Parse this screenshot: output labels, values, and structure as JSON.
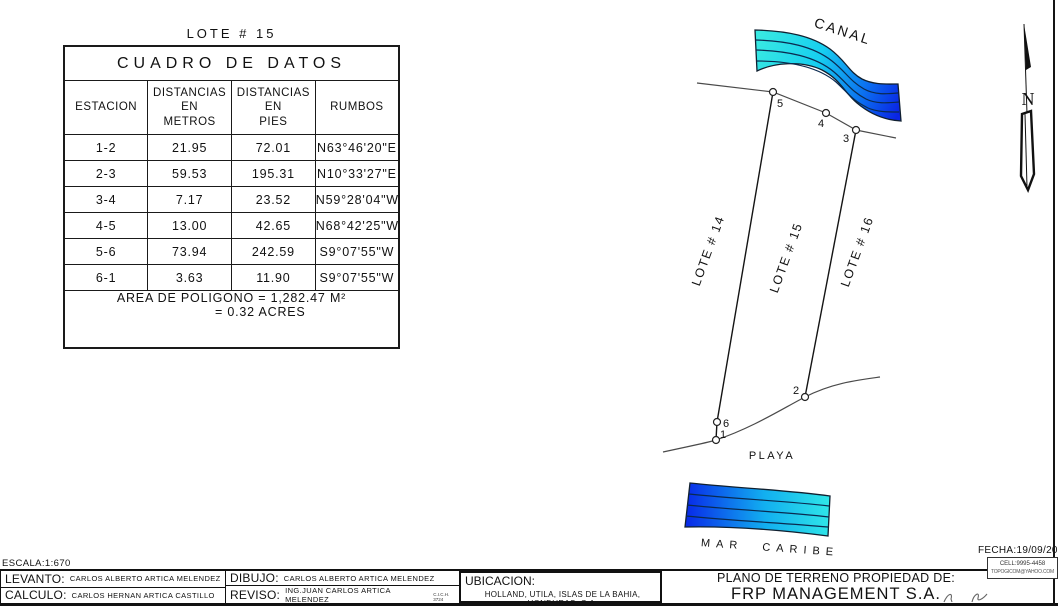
{
  "page": {
    "lot_title": "LOTE # 15",
    "scale": "ESCALA:1:670",
    "date": "FECHA:19/09/2023",
    "cell": "CELL:9995-4458",
    "email": "TOPOGICOM@YAHOO.COM"
  },
  "table": {
    "title": "CUADRO DE DATOS",
    "headers": [
      "ESTACION",
      "DISTANCIAS\nEN\nMETROS",
      "DISTANCIAS\nEN\nPIES",
      "RUMBOS"
    ],
    "rows": [
      [
        "1-2",
        "21.95",
        "72.01",
        "N63°46'20\"E"
      ],
      [
        "2-3",
        "59.53",
        "195.31",
        "N10°33'27\"E"
      ],
      [
        "3-4",
        "7.17",
        "23.52",
        "N59°28'04\"W"
      ],
      [
        "4-5",
        "13.00",
        "42.65",
        "N68°42'25\"W"
      ],
      [
        "5-6",
        "73.94",
        "242.59",
        "S9°07'55\"W"
      ],
      [
        "6-1",
        "3.63",
        "11.90",
        "S9°07'55\"W"
      ]
    ],
    "area_line1": "AREA DE POLIGONO = 1,282.47 M²",
    "area_line2": "= 0.32 ACRES"
  },
  "plan": {
    "canal_label": "CANAL",
    "playa_label": "PLAYA",
    "sea_label": "MAR CARIBE",
    "north_label": "N",
    "lot_labels": [
      "LOTE # 14",
      "LOTE # 15",
      "LOTE # 16"
    ],
    "point_labels": [
      "1",
      "2",
      "3",
      "4",
      "5",
      "6"
    ],
    "colors": {
      "water_cyan": "#35E8E3",
      "water_mid": "#14BEF0",
      "water_blue": "#0927E6"
    }
  },
  "title_block": {
    "levanto": {
      "label": "LEVANTO:",
      "value": "CARLOS ALBERTO ARTICA MELENDEZ"
    },
    "calculo": {
      "label": "CALCULO:",
      "value": "CARLOS HERNAN ARTICA CASTILLO"
    },
    "dibujo": {
      "label": "DIBUJO:",
      "value": "CARLOS ALBERTO ARTICA MELENDEZ"
    },
    "reviso": {
      "label": "REVISO:",
      "value": "ING.JUAN CARLOS ARTICA MELENDEZ",
      "note": "C.I.C.H. 3724"
    },
    "ubicacion": {
      "label": "UBICACION:",
      "value": "HOLLAND, UTILA, ISLAS DE LA BAHIA, HONDURAS, C.A."
    },
    "plano": {
      "line1": "PLANO DE TERRENO PROPIEDAD DE:",
      "line2": "FRP MANAGEMENT S.A."
    }
  }
}
